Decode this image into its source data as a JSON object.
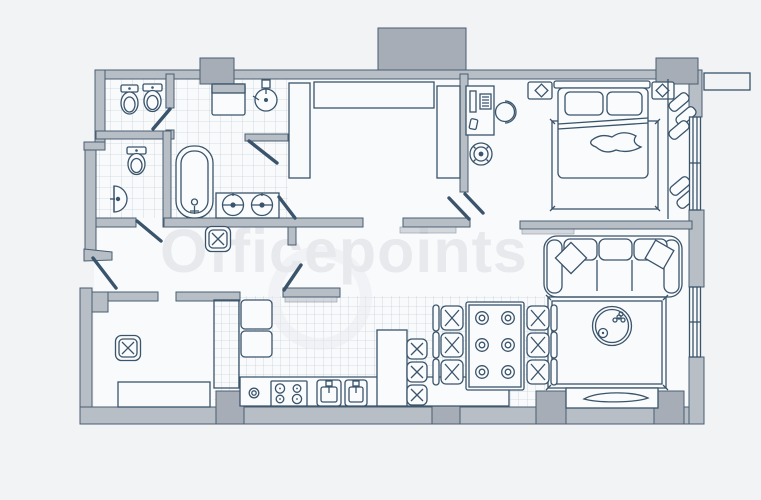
{
  "watermark": {
    "text": "Officepoints"
  },
  "palette": {
    "bg": "#f2f3f5",
    "floor": "#f9fafb",
    "wall": "#b7bec6",
    "wall_dark": "#a6adb6",
    "wall_stroke": "#4a5e72",
    "line": "#3a546b",
    "tile": "#c9d3dc",
    "fixture": "#fafbfc",
    "watermark": "#e7e9ed"
  },
  "fixtures": [
    "bidet-icon",
    "toilet-icon",
    "wall-sink-icon",
    "bathtub-icon",
    "double-vanity-icon",
    "corner-sink-icon",
    "washing-machine-icon",
    "vent-shaft-icon",
    "wardrobe-icon",
    "desk-icon",
    "monitor-icon",
    "keyboard-icon",
    "office-chair-icon",
    "fan-icon",
    "double-bed-icon",
    "pillow-icon",
    "nightstand-icon",
    "lamp-icon",
    "rug-icon",
    "balcony-box-icon",
    "sofa-icon",
    "cushion-icon",
    "coffee-table-icon",
    "plant-icon",
    "tv-stand-icon",
    "tv-icon",
    "dining-table-icon",
    "dining-chair-icon",
    "plate-icon",
    "bar-stool-icon",
    "kitchen-island-icon",
    "tall-cabinet-icon",
    "cabinet-icon",
    "counter-icon",
    "stove-icon",
    "kitchen-sink-icon",
    "radiator-icon",
    "pouf-icon",
    "door-icon",
    "window-icon",
    "external-unit-icon"
  ]
}
